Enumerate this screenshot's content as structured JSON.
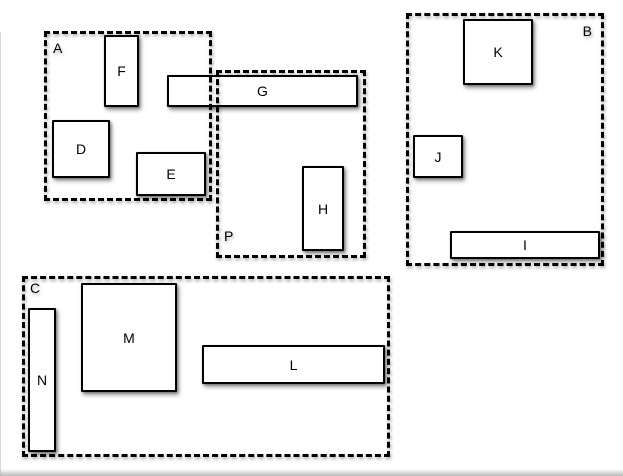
{
  "figure": {
    "description": "Diagram of labelled solid rectangles grouped inside dashed outline regions"
  },
  "colors": {
    "background": "#ffffff",
    "stroke": "#000000",
    "shape_fill": "#ffffff"
  },
  "groups": {
    "A": {
      "label": "A",
      "label_position": "top-left"
    },
    "B": {
      "label": "B",
      "label_position": "top-right"
    },
    "C": {
      "label": "C",
      "label_position": "top-left"
    },
    "P": {
      "label": "P",
      "label_position": "bottom-left"
    }
  },
  "boxes": {
    "D": {
      "label": "D",
      "group": "A"
    },
    "E": {
      "label": "E",
      "group": "A"
    },
    "F": {
      "label": "F",
      "group": "A"
    },
    "G": {
      "label": "G",
      "group": "A and P (spans both)"
    },
    "H": {
      "label": "H",
      "group": "P"
    },
    "I": {
      "label": "I",
      "group": "B"
    },
    "J": {
      "label": "J",
      "group": "B"
    },
    "K": {
      "label": "K",
      "group": "B"
    },
    "L": {
      "label": "L",
      "group": "C"
    },
    "M": {
      "label": "M",
      "group": "C"
    },
    "N": {
      "label": "N",
      "group": "C"
    }
  }
}
